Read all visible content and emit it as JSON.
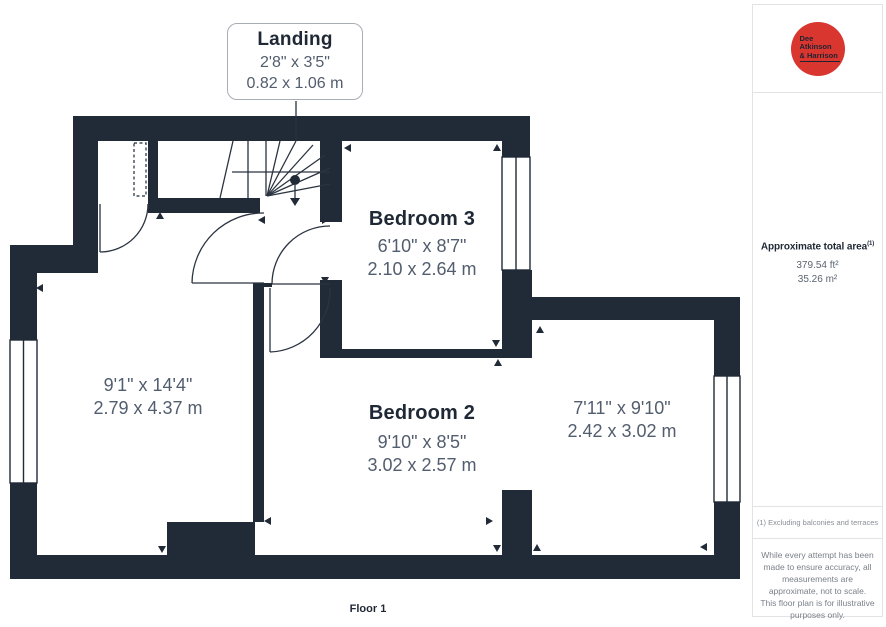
{
  "callout": {
    "title": "Landing",
    "imperial": "2'8\" x 3'5\"",
    "metric": "0.82 x 1.06 m"
  },
  "rooms": {
    "bedroom3": {
      "name": "Bedroom 3",
      "imperial": "6'10\" x 8'7\"",
      "metric": "2.10 x 2.64 m"
    },
    "bedroom2": {
      "name": "Bedroom 2",
      "imperial": "9'10\" x 8'5\"",
      "metric": "3.02 x 2.57 m"
    },
    "left_room": {
      "imperial": "9'1\" x 14'4\"",
      "metric": "2.79 x 4.37 m"
    },
    "right_room": {
      "imperial": "7'11\" x 9'10\"",
      "metric": "2.42 x 3.02 m"
    }
  },
  "floor_label": "Floor 1",
  "sidebar": {
    "logo": {
      "line1": "Dee",
      "line2": "Atkinson",
      "line3": "& Harrison",
      "color": "#d9362f"
    },
    "area": {
      "title": "Approximate total area",
      "superscript": "(1)",
      "imperial": "379.54 ft²",
      "metric": "35.26 m²"
    },
    "footnote": "(1) Excluding balconies and terraces",
    "disclaimer": "While every attempt has been made to ensure accuracy, all measurements are approximate, not to scale. This floor plan is for illustrative purposes only.",
    "brand": {
      "name": "GIRAFFE",
      "suffix": "360"
    }
  },
  "colors": {
    "wall": "#212a37",
    "line": "#2a3340",
    "dim_text": "#525d6e",
    "accent_red": "#d9362f"
  }
}
